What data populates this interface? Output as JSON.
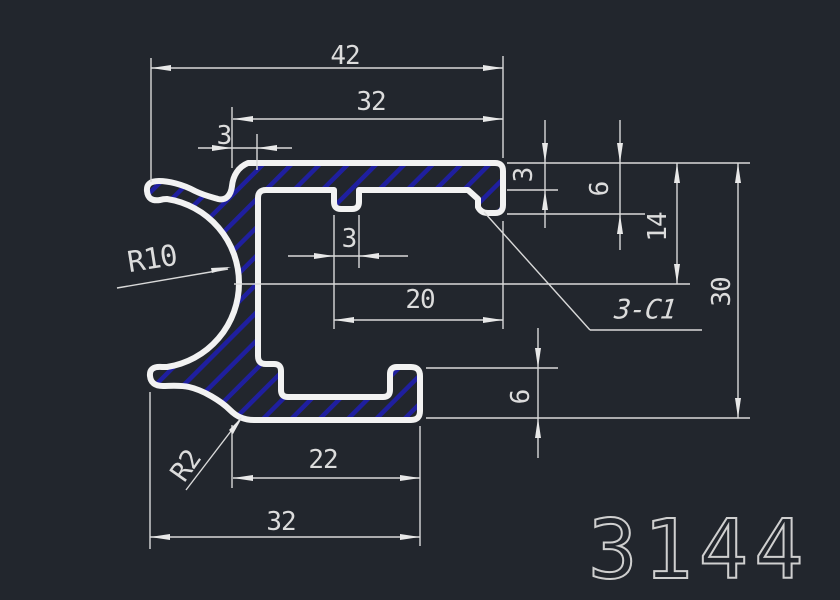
{
  "colors": {
    "background": "#22262d",
    "outline": "#f2f2f2",
    "dimension_lines": "#d9d9d9",
    "hatch": "#1f1f9f",
    "text": "#dcdcdc"
  },
  "labels": {
    "width_top": "42",
    "width_flange": "32",
    "wall_thickness": "3",
    "flange_thickness": "3",
    "lip_depth": "6",
    "jaw_axis": "14",
    "height_total": "30",
    "slot_width": "3",
    "cavity_width": "20",
    "jaw_radius": "R10",
    "chamfer_note": "3-C1",
    "tab_height": "6",
    "fillet_radius": "R2",
    "tab_width": "22",
    "width_bottom": "32",
    "part_number": "3144"
  }
}
